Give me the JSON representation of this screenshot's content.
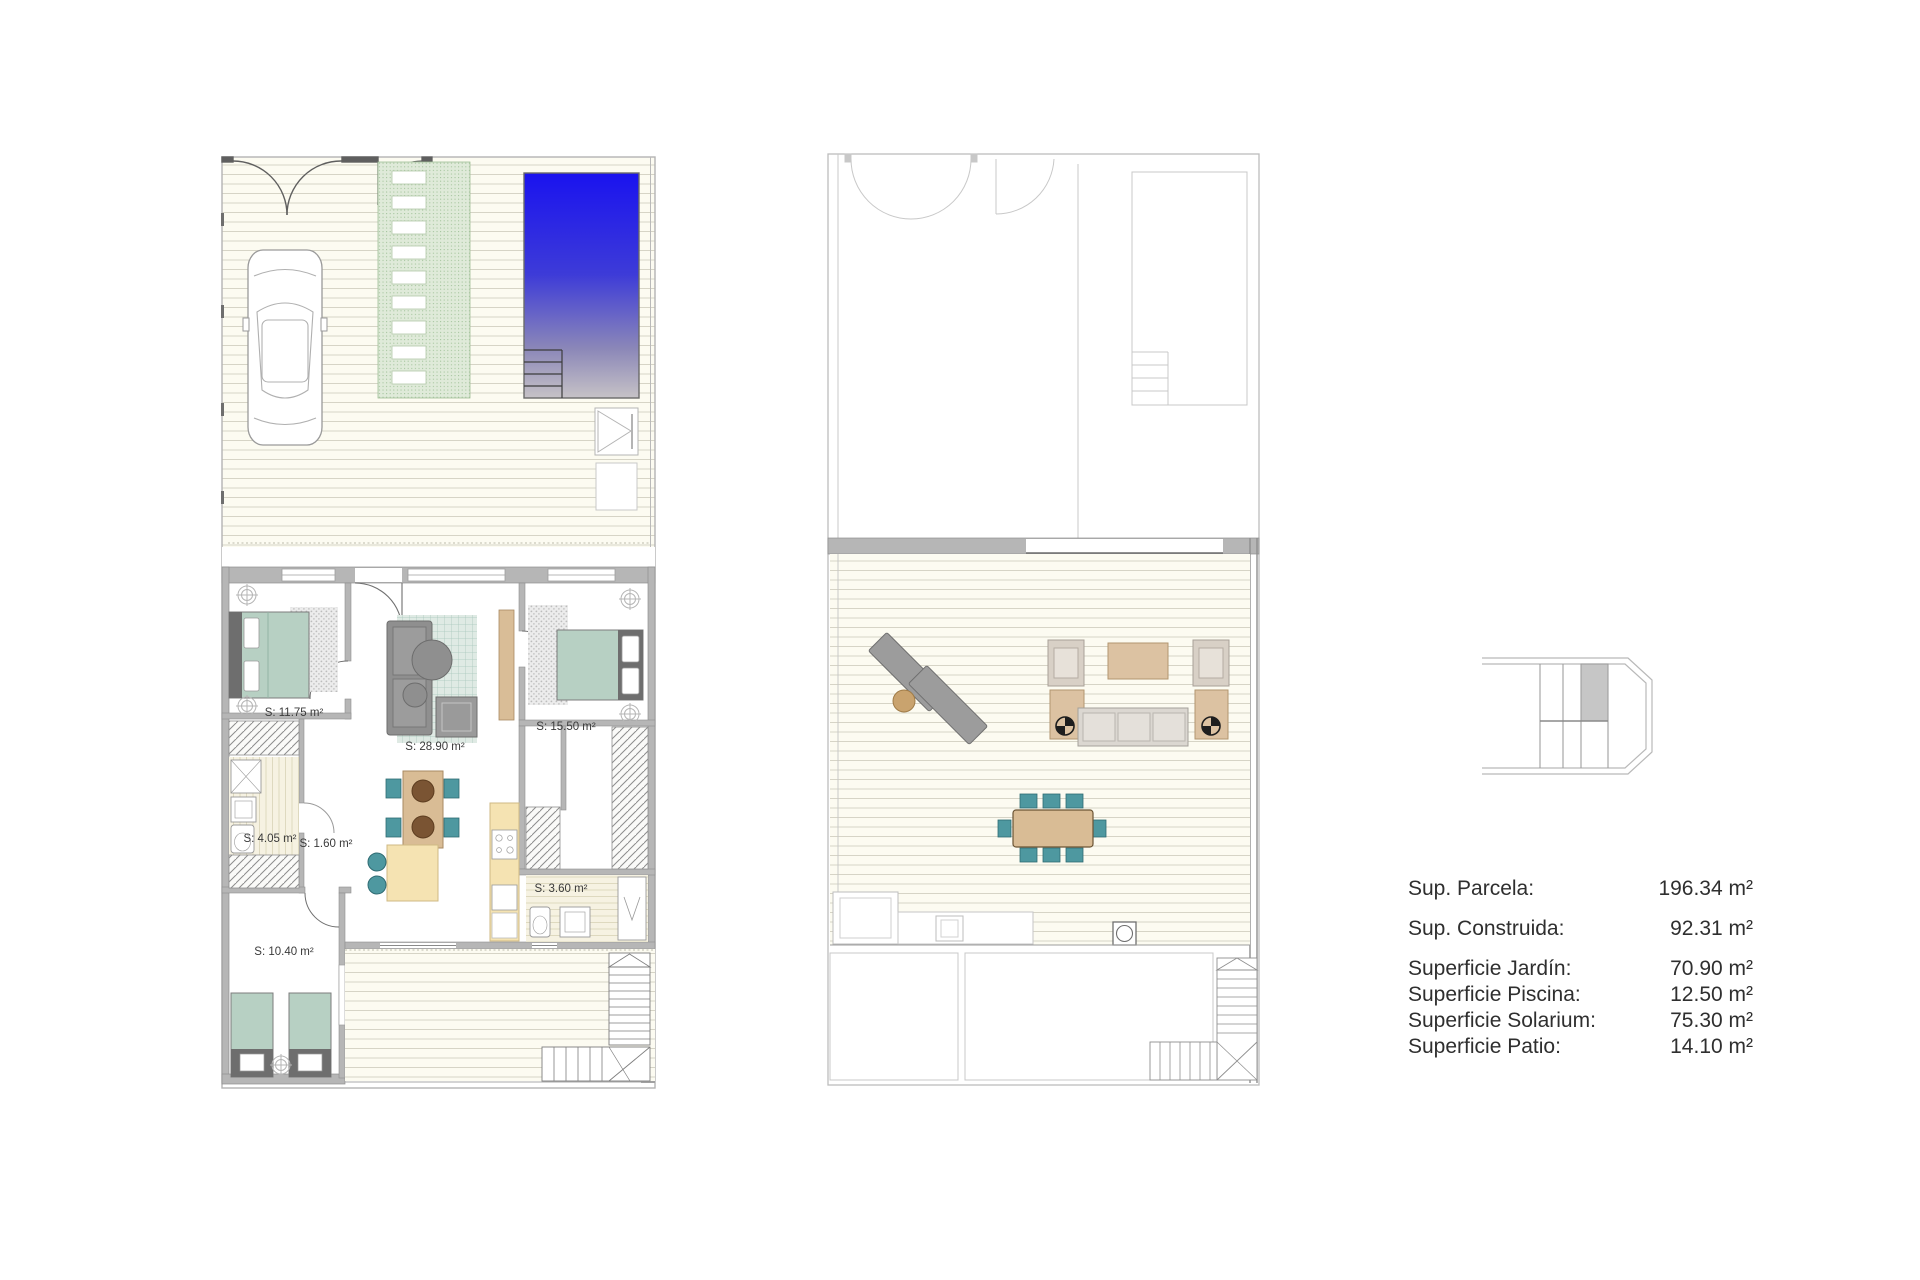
{
  "sheet": {
    "background": "#ffffff",
    "description": "townhouse floor plans with surface legend"
  },
  "ground_floor": {
    "rooms": [
      {
        "id": "bedroom-1",
        "label": "S: 11.75 m²"
      },
      {
        "id": "living-room",
        "label": "S: 28.90 m²"
      },
      {
        "id": "bedroom-2",
        "label": "S: 15.50 m²"
      },
      {
        "id": "bathroom-1",
        "label": "S: 4.05 m²"
      },
      {
        "id": "hall",
        "label": "S: 1.60 m²"
      },
      {
        "id": "bathroom-2",
        "label": "S: 3.60 m²"
      },
      {
        "id": "bedroom-3",
        "label": "S: 10.40 m²"
      }
    ]
  },
  "legend": {
    "rows": [
      {
        "label": "Sup. Parcela:",
        "value": "196.34 m²"
      },
      {
        "label": "Sup. Construida:",
        "value": "92.31 m²"
      },
      {
        "label": "Superficie Jardín:",
        "value": "70.90 m²"
      },
      {
        "label": "Superficie Piscina:",
        "value": "12.50 m²"
      },
      {
        "label": "Superficie Solarium:",
        "value": "75.30 m²"
      },
      {
        "label": "Superficie Patio:",
        "value": "14.10 m²"
      }
    ]
  },
  "colors": {
    "pool_top": "#1a13ef",
    "pool_fade": "#c6c2c6",
    "path_green": "#dfead9",
    "bed_green": "#b7d0c3",
    "chair_teal": "#4e98a0",
    "counter_yellow": "#f5e3b2",
    "wood_tan": "#d9bc95",
    "lounger_gray": "#9c9c9c",
    "wall_gray": "#b6b6b6",
    "deck_cream": "#fcfbf1",
    "keyplan_highlight": "#c6c6c6"
  }
}
